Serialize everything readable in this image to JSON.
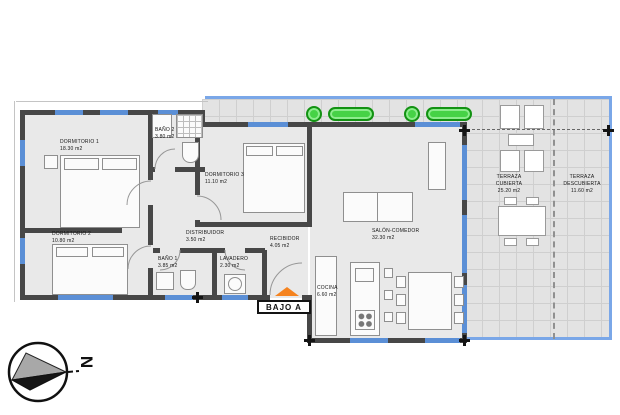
{
  "plan": {
    "unit_label": "BAJO A",
    "compass_letter": "N",
    "rooms": [
      {
        "id": "dormitorio-1",
        "name": "DORMITORIO 1",
        "area": "18.30 m2"
      },
      {
        "id": "bano-2",
        "name": "BAÑO 2",
        "area": "3.80 m2"
      },
      {
        "id": "dormitorio-3",
        "name": "DORMITORIO 3",
        "area": "11.10 m2"
      },
      {
        "id": "dormitorio-2",
        "name": "DORMITORIO 2",
        "area": "10.80 m2"
      },
      {
        "id": "distribuidor",
        "name": "DISTRIBUIDOR",
        "area": "3.50 m2"
      },
      {
        "id": "bano-1",
        "name": "BAÑO 1",
        "area": "3.85 m2"
      },
      {
        "id": "lavadero",
        "name": "LAVADERO",
        "area": "2.30 m2"
      },
      {
        "id": "recibidor",
        "name": "RECIBIDOR",
        "area": "4.05 m2"
      },
      {
        "id": "salon-comedor",
        "name": "SALÓN-COMEDOR",
        "area": "32.30 m2"
      },
      {
        "id": "cocina",
        "name": "COCINA",
        "area": "6.60 m2"
      },
      {
        "id": "terraza-cubierta",
        "name": "TERRAZA CUBIERTA",
        "area": "25.20 m2"
      },
      {
        "id": "terraza-descubierta",
        "name": "TERRAZA DESCUBIERTA",
        "area": "11.60 m2"
      }
    ],
    "colors": {
      "wall": "#474747",
      "interior_floor": "#e9e9e9",
      "terrace_floor": "#e3e3e3",
      "window_blue": "#5b8fd6",
      "terrace_edge_blue": "#7aa7e8",
      "plant_green": "#46d246",
      "entrance_orange": "#f5831f"
    }
  }
}
